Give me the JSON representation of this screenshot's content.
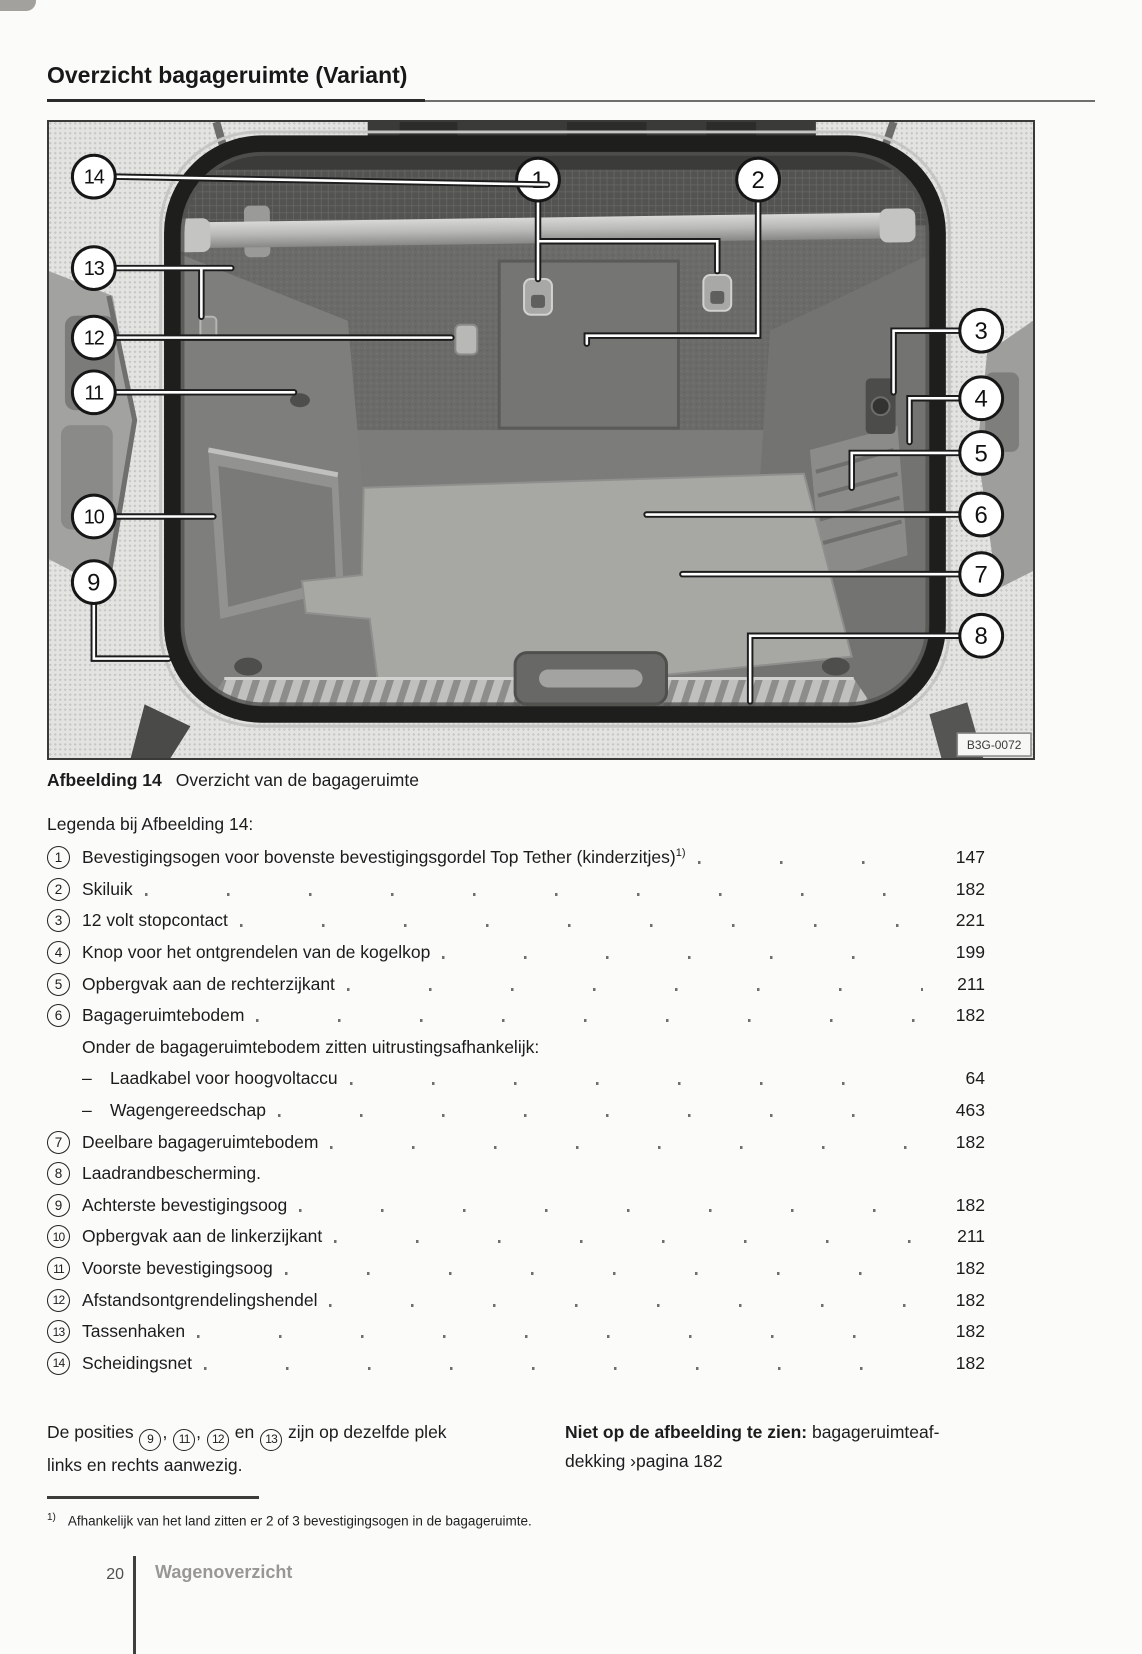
{
  "title": "Overzicht bagageruimte (Variant)",
  "figure": {
    "caption_label": "Afbeelding 14",
    "caption_text": "Overzicht van de bagageruimte",
    "image_code": "B3G-0072",
    "callouts": [
      {
        "label": "1",
        "cx": 491,
        "cy": 58,
        "path": "M491,79 V158 M491,120 H671 V150"
      },
      {
        "label": "2",
        "cx": 712,
        "cy": 58,
        "path": "M712,79 V215 H540 v8"
      },
      {
        "label": "3",
        "cx": 936,
        "cy": 210,
        "path": "M913,210 H848 V272"
      },
      {
        "label": "4",
        "cx": 936,
        "cy": 278,
        "path": "M913,278 H864 V322"
      },
      {
        "label": "5",
        "cx": 936,
        "cy": 333,
        "path": "M913,333 H806 V368"
      },
      {
        "label": "6",
        "cx": 936,
        "cy": 395,
        "path": "M913,395 H600"
      },
      {
        "label": "7",
        "cx": 936,
        "cy": 455,
        "path": "M913,455 H636"
      },
      {
        "label": "8",
        "cx": 936,
        "cy": 517,
        "path": "M913,517 H704 V583"
      },
      {
        "label": "9",
        "cx": 45,
        "cy": 463,
        "path": "M45,485 V540 H120"
      },
      {
        "label": "10",
        "cx": 45,
        "cy": 397,
        "path": "M67,397 H165"
      },
      {
        "label": "11",
        "cx": 45,
        "cy": 272,
        "path": "M67,272 H246"
      },
      {
        "label": "12",
        "cx": 45,
        "cy": 217,
        "path": "M67,217 H404"
      },
      {
        "label": "13",
        "cx": 45,
        "cy": 147,
        "path": "M67,147 H183 M153,147 V196"
      },
      {
        "label": "14",
        "cx": 45,
        "cy": 55,
        "path": "M67,55 L500,63"
      }
    ]
  },
  "legend": {
    "intro": "Legenda bij Afbeelding 14:",
    "items": [
      {
        "type": "item",
        "marker": "1",
        "text": "Bevestigingsogen voor bovenste bevestigingsgordel Top Tether (kinderzitjes)",
        "sup": "1)",
        "page": "147"
      },
      {
        "type": "item",
        "marker": "2",
        "text": "Skiluik",
        "page": "182"
      },
      {
        "type": "item",
        "marker": "3",
        "text": "12 volt stopcontact",
        "page": "221"
      },
      {
        "type": "item",
        "marker": "4",
        "text": "Knop voor het ontgrendelen van de kogelkop",
        "page": "199"
      },
      {
        "type": "item",
        "marker": "5",
        "text": "Opbergvak aan de rechterzijkant",
        "page": "211"
      },
      {
        "type": "item",
        "marker": "6",
        "text": "Bagageruimtebodem",
        "page": "182"
      },
      {
        "type": "sub",
        "text": "Onder de bagageruimtebodem zitten uitrustingsafhankelijk:",
        "page": ""
      },
      {
        "type": "dash",
        "text": "Laadkabel voor hoogvoltaccu",
        "page": "64"
      },
      {
        "type": "dash",
        "text": "Wagengereedschap",
        "page": "463"
      },
      {
        "type": "item",
        "marker": "7",
        "text": "Deelbare bagageruimtebodem",
        "page": "182"
      },
      {
        "type": "item",
        "marker": "8",
        "text": "Laadrandbescherming.",
        "page": ""
      },
      {
        "type": "item",
        "marker": "9",
        "text": "Achterste bevestigingsoog",
        "page": "182"
      },
      {
        "type": "item",
        "marker": "10",
        "text": "Opbergvak aan de linkerzijkant",
        "page": "211"
      },
      {
        "type": "item",
        "marker": "11",
        "text": "Voorste bevestigingsoog",
        "page": "182"
      },
      {
        "type": "item",
        "marker": "12",
        "text": "Afstandsontgrendelingshendel",
        "page": "182"
      },
      {
        "type": "item",
        "marker": "13",
        "text": "Tassenhaken",
        "page": "182"
      },
      {
        "type": "item",
        "marker": "14",
        "text": "Scheidingsnet",
        "page": "182"
      }
    ]
  },
  "notes": {
    "left_segments": [
      {
        "t": "text",
        "v": "De posities "
      },
      {
        "t": "circle",
        "v": "9"
      },
      {
        "t": "text",
        "v": ", "
      },
      {
        "t": "circle",
        "v": "11"
      },
      {
        "t": "text",
        "v": ", "
      },
      {
        "t": "circle",
        "v": "12"
      },
      {
        "t": "text",
        "v": " en "
      },
      {
        "t": "circle",
        "v": "13"
      },
      {
        "t": "text",
        "v": " zijn op dezelfde plek"
      },
      {
        "t": "br"
      },
      {
        "t": "text",
        "v": "links en rechts aanwezig."
      }
    ],
    "right_bold": "Niet op de afbeelding te zien:",
    "right_line1_rest": " bagageruimteaf-",
    "right_line2": "dekking ›pagina 182"
  },
  "footnote": {
    "marker": "1)",
    "text": "Afhankelijk van het land zitten er 2 of 3 bevestigingsogen in de bagageruimte."
  },
  "footer": {
    "page_number": "20",
    "section": "Wagenoverzicht"
  }
}
